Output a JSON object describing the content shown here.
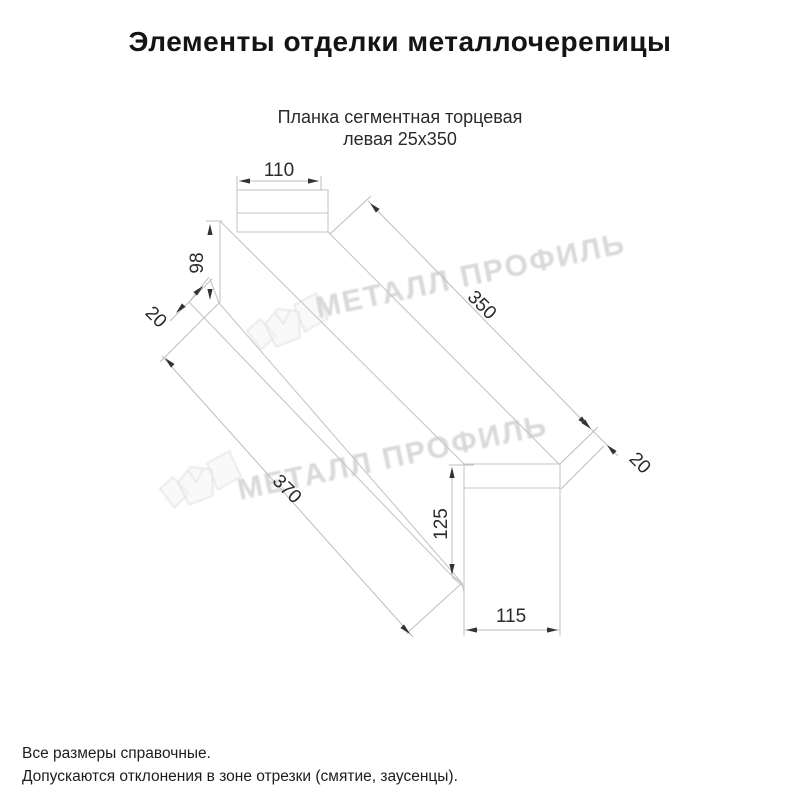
{
  "title": "Элементы отделки металлочерепицы",
  "subtitle": {
    "line1": "Планка сегментная торцевая",
    "line2": "левая 25х350"
  },
  "drawing": {
    "description": "Axonometric sketch of left segmental end trim strip",
    "dims": {
      "flange_width": "110",
      "back_height": "98",
      "hem": "20",
      "length_top": "350",
      "length_bottom": "370",
      "end_height": "125",
      "end_width": "115",
      "end_flange": "20"
    },
    "watermark_text": "МЕТАЛЛ ПРОФИЛЬ"
  },
  "footnotes": {
    "line1": "Все размеры справочные.",
    "line2": "Допускаются отклонения в зоне отрезки (смятие, заусенцы)."
  },
  "colors": {
    "line": "#c6c6c6",
    "dim_line": "#bdbdbd",
    "dim_text": "#2a2a2a",
    "arrow": "#333333",
    "watermark": "#d9d9d9",
    "background": "#ffffff"
  }
}
